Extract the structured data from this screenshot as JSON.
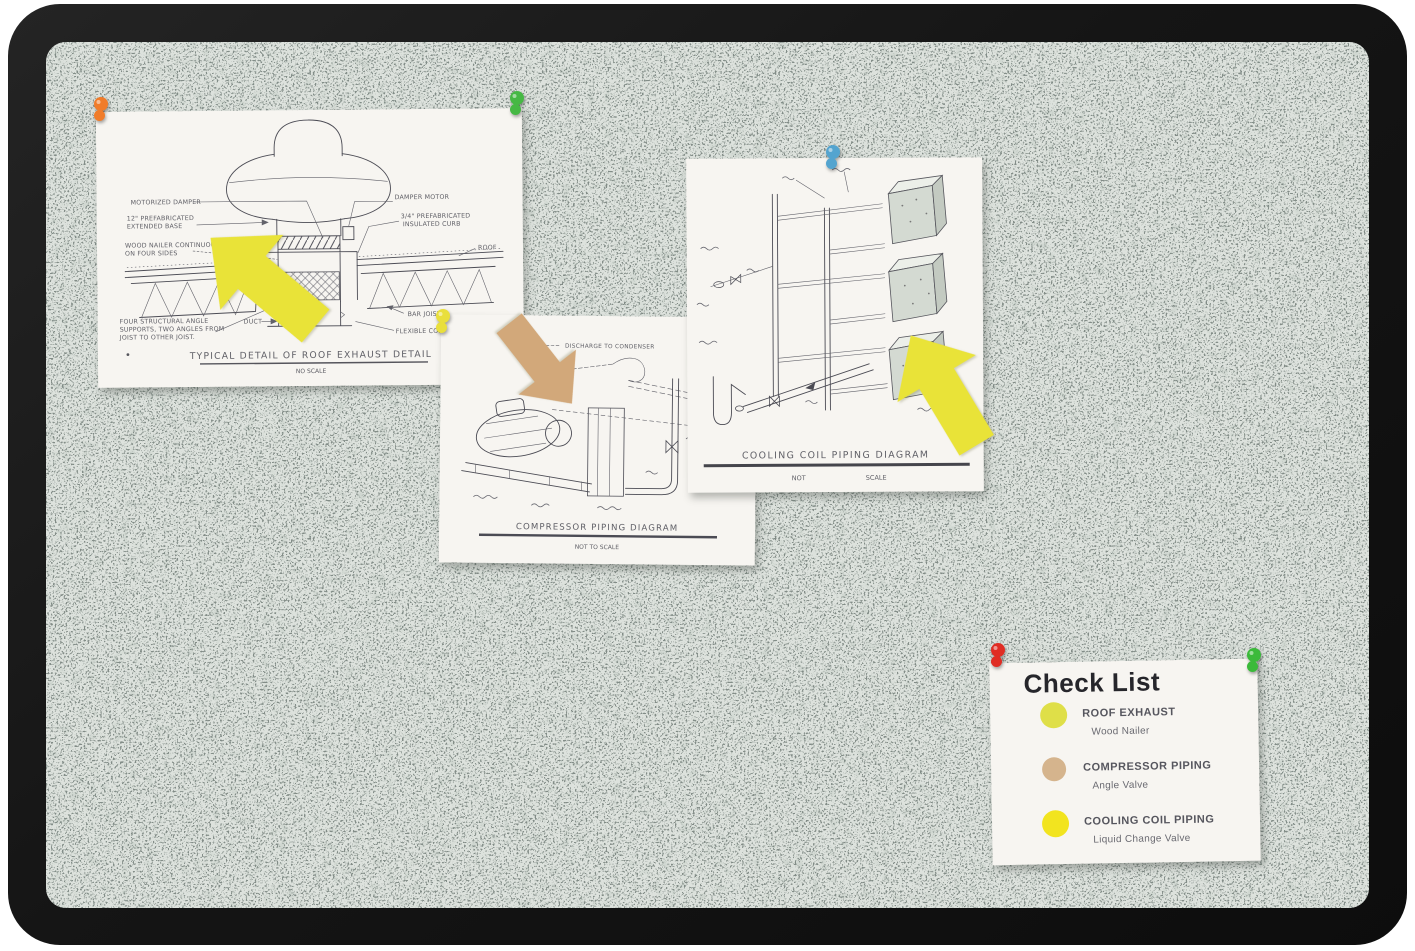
{
  "photo": {
    "background_color": "#ffffff",
    "frame_color": "#161616",
    "cork_base_color": "#dde2dd"
  },
  "diagrams": {
    "roof_exhaust": {
      "title": "TYPICAL DETAIL OF ROOF EXHAUST DETAIL",
      "scale_note": "NO SCALE",
      "labels": {
        "motorized_damper": "MOTORIZED DAMPER",
        "prefab_base_1": "12\" PREFABRICATED",
        "prefab_base_2": "EXTENDED BASE",
        "wood_nailer_1": "WOOD NAILER CONTINUOUS",
        "wood_nailer_2": "ON FOUR SIDES",
        "angle_supports_1": "FOUR STRUCTURAL ANGLE",
        "angle_supports_2": "SUPPORTS, TWO ANGLES FROM",
        "angle_supports_3": "JOIST TO OTHER JOIST.",
        "duct": "DUCT",
        "damper_motor": "DAMPER MOTOR",
        "insulated_curb_1": "3/4\" PREFABRICATED",
        "insulated_curb_2": "INSULATED CURB",
        "roof": "ROOF",
        "bar_joist": "BAR JOIST",
        "flexible_connections": "FLEXIBLE CONNECTIONS"
      }
    },
    "compressor": {
      "title": "COMPRESSOR PIPING DIAGRAM",
      "scale_note": "NOT TO SCALE",
      "labels": {
        "discharge": "DISCHARGE TO CONDENSER"
      }
    },
    "cooling_coil": {
      "title": "COOLING COIL PIPING DIAGRAM",
      "scale_note_left": "NOT",
      "scale_note_right": "SCALE"
    }
  },
  "checklist": {
    "title": "Check List",
    "items": [
      {
        "label": "ROOF EXHAUST",
        "sub": "Wood Nailer",
        "dot_color": "#dfdf48"
      },
      {
        "label": "COMPRESSOR PIPING",
        "sub": "Angle Valve",
        "dot_color": "#d5b48d"
      },
      {
        "label": "COOLING COIL PIPING",
        "sub": "Liquid Change Valve",
        "dot_color": "#f2e41f"
      }
    ]
  },
  "pins": {
    "orange": "#f07c2a",
    "green_top": "#46b844",
    "yellow": "#e9df3c",
    "blue": "#54a4cf",
    "red": "#e02d24",
    "green_bottom": "#3bba3a"
  },
  "arrows": {
    "yellow": "#e9e338",
    "tan": "#d2a87a"
  }
}
